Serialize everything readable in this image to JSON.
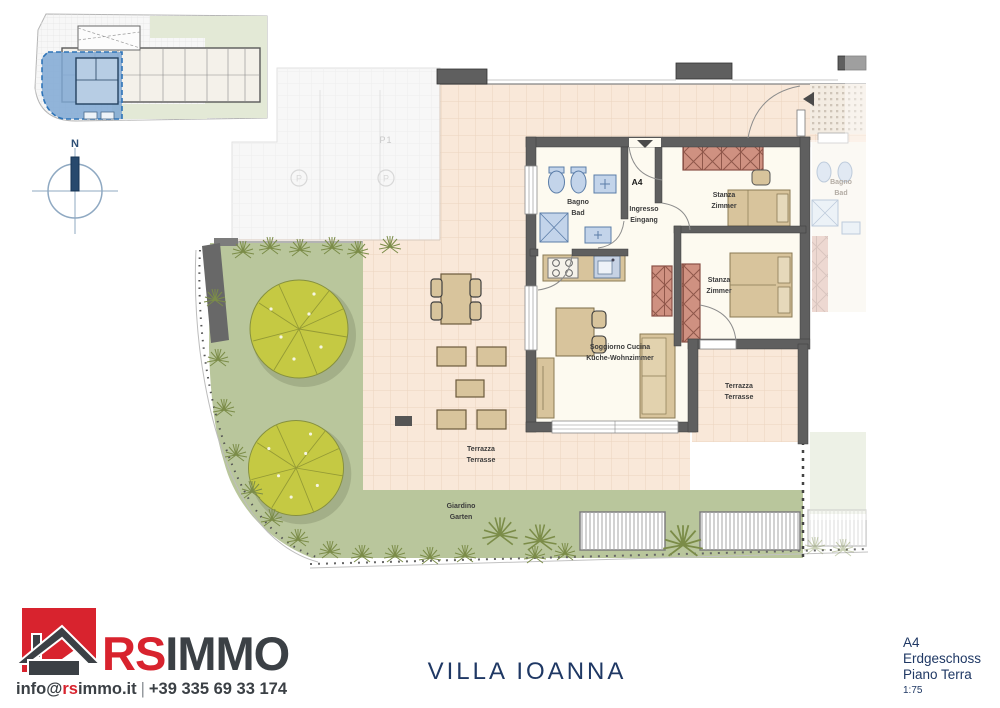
{
  "compass": {
    "north_label": "N"
  },
  "icons": {
    "parking_letter": "P",
    "north_arrow": "north-bar",
    "entrance_arrow": "triangle-marker"
  },
  "plan": {
    "unit": "A4",
    "parking": "P1",
    "labels": {
      "bathroom": {
        "l1": "Bagno",
        "l2": "Bad"
      },
      "entrance_room": {
        "l1": "Ingresso",
        "l2": "Eingang"
      },
      "bedroom1": {
        "l1": "Stanza",
        "l2": "Zimmer"
      },
      "bedroom2": {
        "l1": "Stanza",
        "l2": "Zimmer"
      },
      "living": {
        "l1": "Soggiorno Cucina",
        "l2": "Küche-Wohnzimmer"
      },
      "terrace_left": {
        "l1": "Terrazza",
        "l2": "Terrasse"
      },
      "terrace_right": {
        "l1": "Terrazza",
        "l2": "Terrasse"
      },
      "garden": {
        "l1": "Giardino",
        "l2": "Garten"
      },
      "adjacent_bathroom": {
        "l1": "Bagno",
        "l2": "Bad"
      }
    }
  },
  "footer": {
    "project_title": "VILLA IOANNA",
    "logo": {
      "brand_red": "RS",
      "brand_dark": "IMMO",
      "email_prefix": "info@",
      "email_red": "rs",
      "email_suffix": "immo.it",
      "separator": "|",
      "phone": "+39 335 69 33 174"
    },
    "plan_info": {
      "unit": "A4",
      "floor_de": "Erdgeschoss",
      "floor_it": "Piano Terra",
      "scale": "1:75"
    }
  },
  "colors": {
    "brand_red": "#d8232e",
    "brand_dark": "#3b4045",
    "navy": "#1f3864",
    "terrace_tile": "#f9e8d9",
    "garden_green": "#b9c69c",
    "wall_gray": "#5f5f5f",
    "highlight_blue": "#7fa8d3",
    "fixture_blue": "#c3d4ea",
    "furniture_tan": "#d8c49c",
    "wardrobe_red": "#cf9181"
  }
}
